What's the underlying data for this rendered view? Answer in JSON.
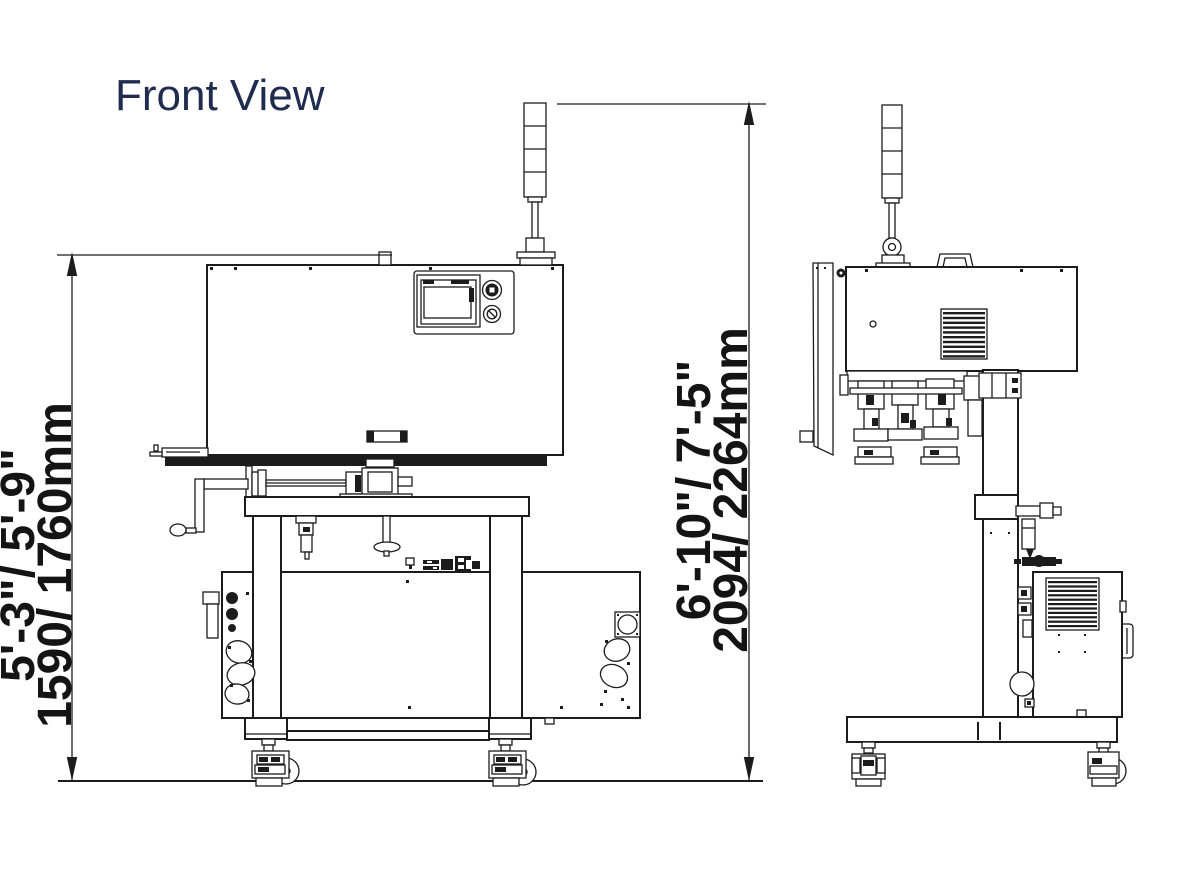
{
  "title": {
    "text": "Front View",
    "color": "#1f2c4e"
  },
  "dimensions": {
    "machine_height": {
      "imperial": "5'-3\"/ 5'-9\"",
      "metric": "1590/ 1760mm"
    },
    "overall_height": {
      "imperial": "6'-10\"/ 7'-5\"",
      "metric": "2094/ 2264mm"
    }
  },
  "drawing": {
    "stroke_color": "#1c1c1c",
    "view_count": 2,
    "views": [
      "front",
      "side"
    ]
  }
}
